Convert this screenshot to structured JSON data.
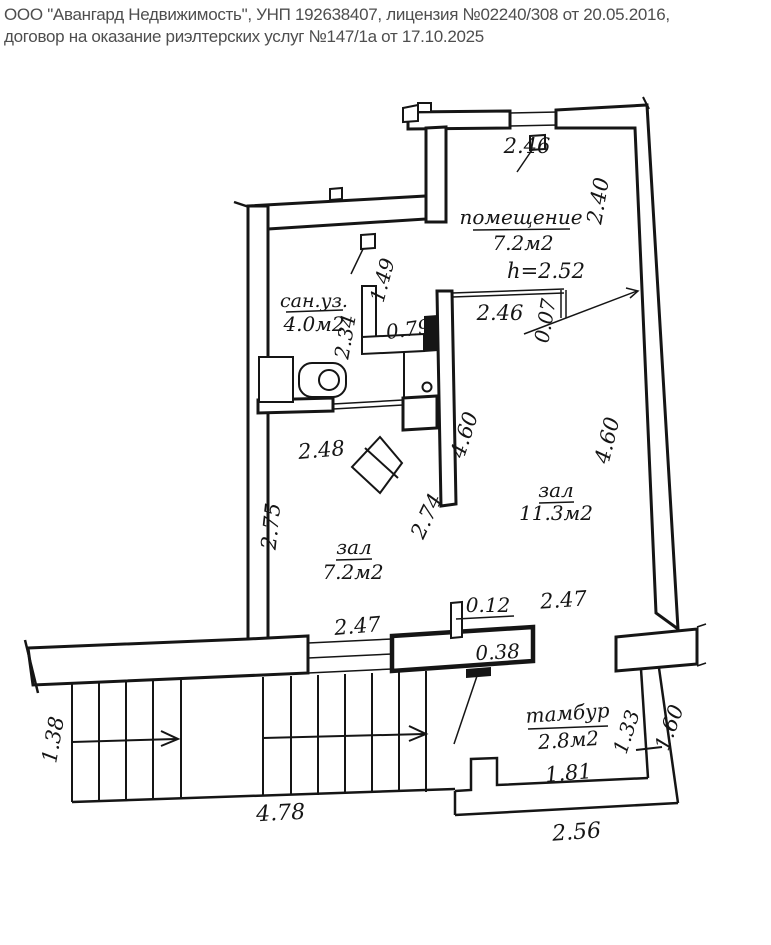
{
  "header": {
    "line1": "ООО \"Авангард Недвижимость\", УНП 192638407, лицензия №02240/308 от 20.05.2016,",
    "line2": "договор на оказание риэлтерских услуг №147/1а от 17.10.2025"
  },
  "rooms": {
    "pomeshchenie": {
      "label": "помещение",
      "area": "7.2м2"
    },
    "sanuzel": {
      "label": "сан.уз.",
      "area": "4.0м2"
    },
    "hall_big": {
      "label": "зал",
      "area": "11.3м2"
    },
    "hall_small": {
      "label": "зал",
      "area": "7.2м2"
    },
    "tambour": {
      "label": "тамбур",
      "area": "2.8м2"
    }
  },
  "notes": {
    "ceiling_height": "h=2.52"
  },
  "dims": {
    "top_window": "2.46",
    "right_wall_upper": "2.40",
    "pom_partition_len": "2.46",
    "pom_partition_thk": "0.07",
    "closet_depth": "1.49",
    "closet_width": "0.79",
    "sanuz_depth": "2.34",
    "inner_wall_len": "4.60",
    "right_wall_len": "4.60",
    "sanuz_width": "2.48",
    "hall_small_left": "2.75",
    "hall_small_right": "2.74",
    "stub_width": "0.12",
    "hall_big_bottom": "2.47",
    "window_width": "2.47",
    "block_width": "0.38",
    "stairs_flight_width": "1.38",
    "stairs_run_len": "4.78",
    "tambour_inner_width": "1.81",
    "tambour_outer_width": "2.56",
    "tambour_right_inner": "1.33",
    "tambour_right_outer": "1.60"
  }
}
